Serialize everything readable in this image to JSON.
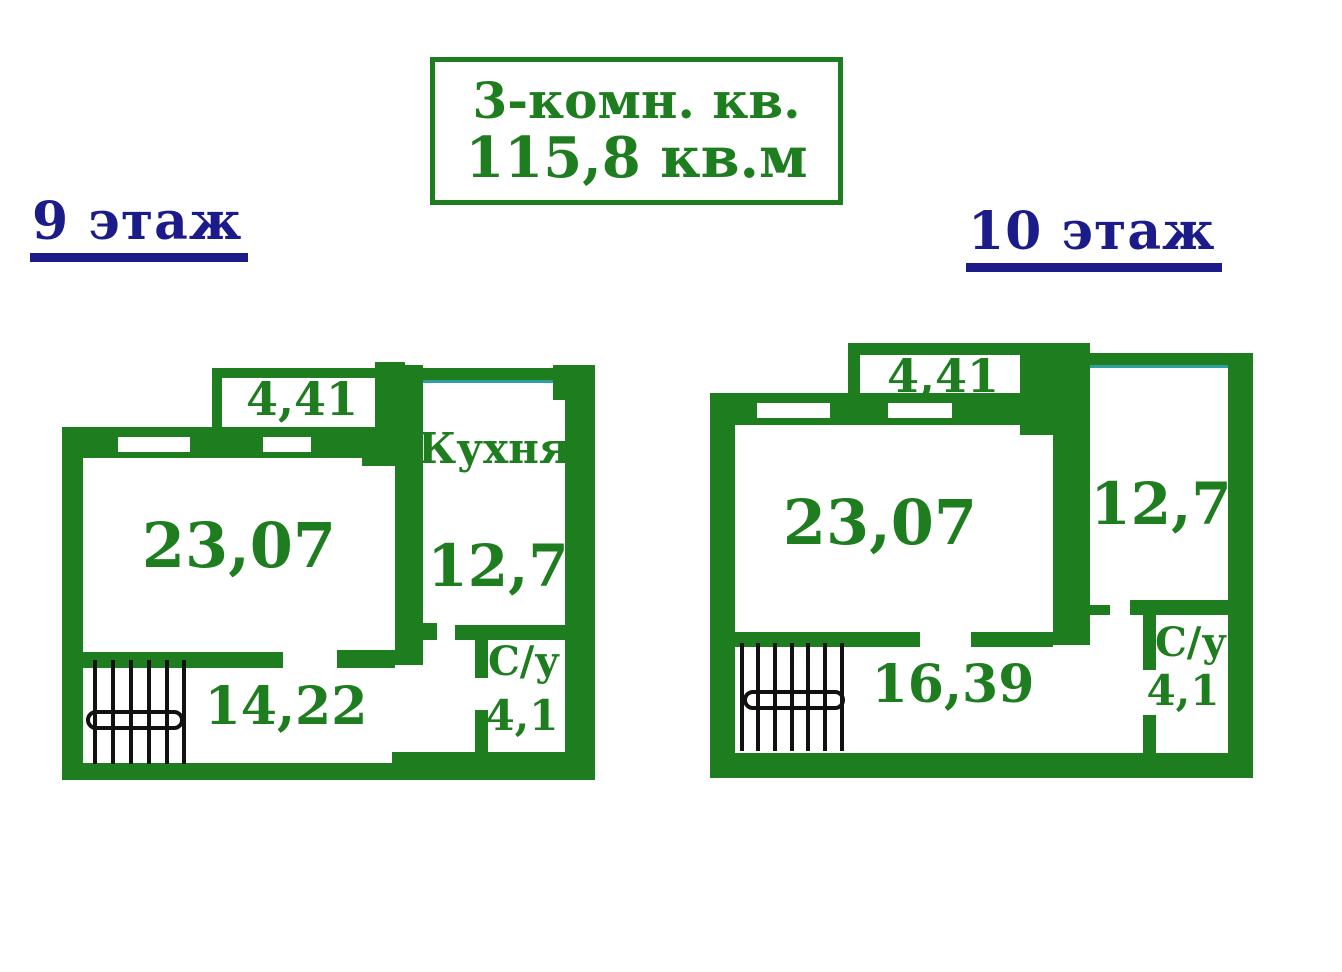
{
  "title_box": {
    "line1": "3-комн. кв.",
    "line2": "115,8 кв.м"
  },
  "floors": [
    {
      "label": "9 этаж",
      "rooms": {
        "balcony_area": "4,41",
        "living_area": "23,07",
        "kitchen_label": "Кухня",
        "kitchen_area": "12,7",
        "hall_area": "14,22",
        "wc_label": "С/у",
        "wc_area": "4,1"
      }
    },
    {
      "label": "10 этаж",
      "rooms": {
        "balcony_area": "4,41",
        "living_area": "23,07",
        "room_area": "12,7",
        "hall_area": "16,39",
        "wc_label": "С/у",
        "wc_area": "4,1"
      }
    }
  ],
  "colors": {
    "wall_green": "#1e7d1e",
    "heading_navy": "#1b1b8a",
    "stair_black": "#111111",
    "window_teal": "#2f9e9e",
    "page_bg": "#ffffff"
  }
}
